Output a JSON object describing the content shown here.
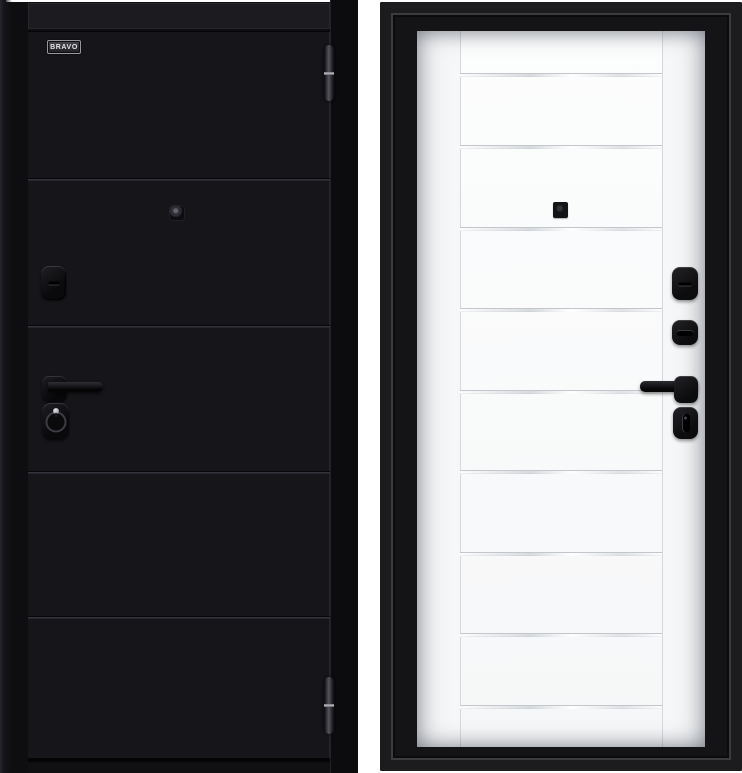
{
  "page": {
    "background_color": "#ffffff",
    "subject": "two-sided steel entrance door product photo"
  },
  "left_door": {
    "side": "exterior",
    "brand_label": "BRAVO",
    "finish_color": "#16161a",
    "frame_color": "#0e0e11",
    "header_color": "#1b1b20",
    "hardware_color": "#101013",
    "panel_divider_y": [
      178,
      325,
      471,
      616
    ],
    "hinges": [
      {
        "y": 45,
        "h": 56
      },
      {
        "y": 677,
        "h": 57
      }
    ],
    "hardware": [
      "peephole",
      "keyhole-cover",
      "lever-handle",
      "lock-escutcheon"
    ]
  },
  "right_door": {
    "side": "interior",
    "leaf_color": "#f6f7f8",
    "frame_color": "#141416",
    "hardware_color": "#101013",
    "panel_divider_y": [
      75,
      147,
      229,
      310,
      392,
      472,
      554,
      635,
      707
    ],
    "stile_x": [
      43,
      245
    ],
    "hardware": [
      "peephole",
      "cylinder-cover",
      "thumbturn",
      "lever-handle",
      "night-latch-knob"
    ]
  }
}
